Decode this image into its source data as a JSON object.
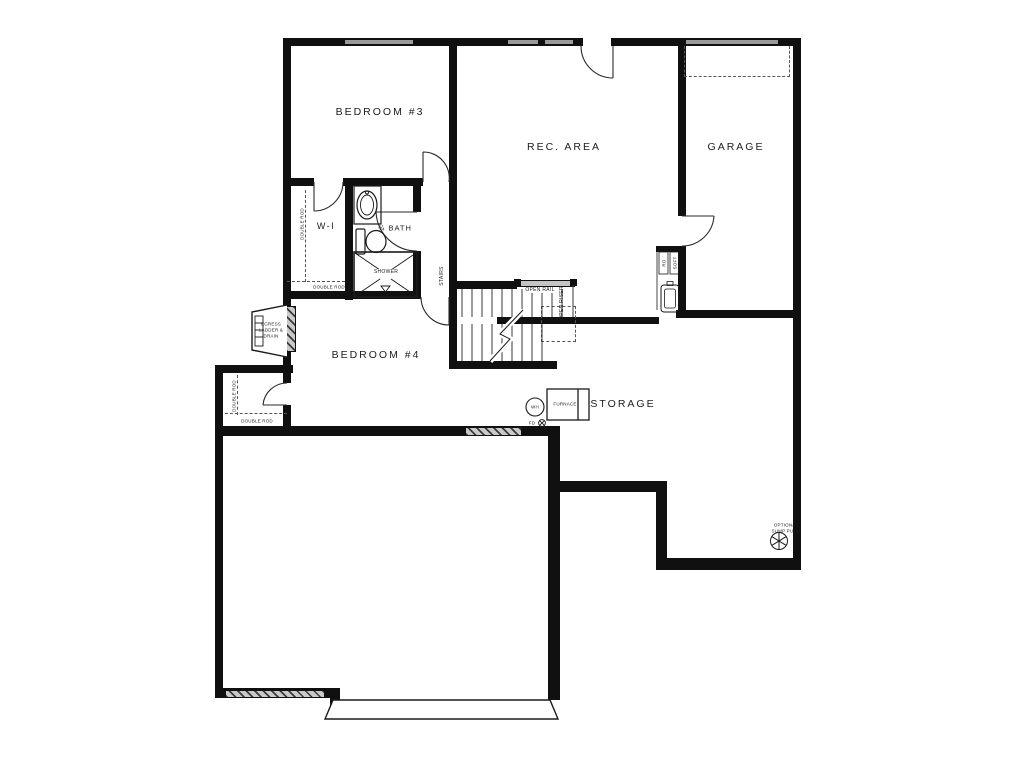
{
  "plan": {
    "title": "Basement floor plan",
    "rooms": {
      "bedroom3": "BEDROOM #3",
      "rec_area": "REC. AREA",
      "garage": "GARAGE",
      "walk_in": "W-I",
      "bath": "¾ BATH",
      "bedroom4": "BEDROOM #4",
      "storage": "STORAGE"
    },
    "annotations": {
      "stairs": "STAIRS",
      "open_rail": "OPEN RAIL",
      "open_riser": "OPEN RISER",
      "shower": "SHOWER",
      "egress_line1": "EGRESS",
      "egress_line2": "LADDER &",
      "egress_line3": "DRAIN",
      "double_rod": "DOUBLE ROD",
      "water_heater": "WH",
      "floor_drain": "FD",
      "furnace": "FURNACE",
      "sump_line1": "OPTIONAL",
      "sump_line2": "SUMP PUMP",
      "utility_left": "RO",
      "utility_right": "SOFT"
    },
    "colors": {
      "wall": "#101010",
      "window_fill": "#9a9a9a",
      "hatch_light": "#c9c9c9",
      "line": "#222222",
      "background": "#ffffff"
    }
  }
}
